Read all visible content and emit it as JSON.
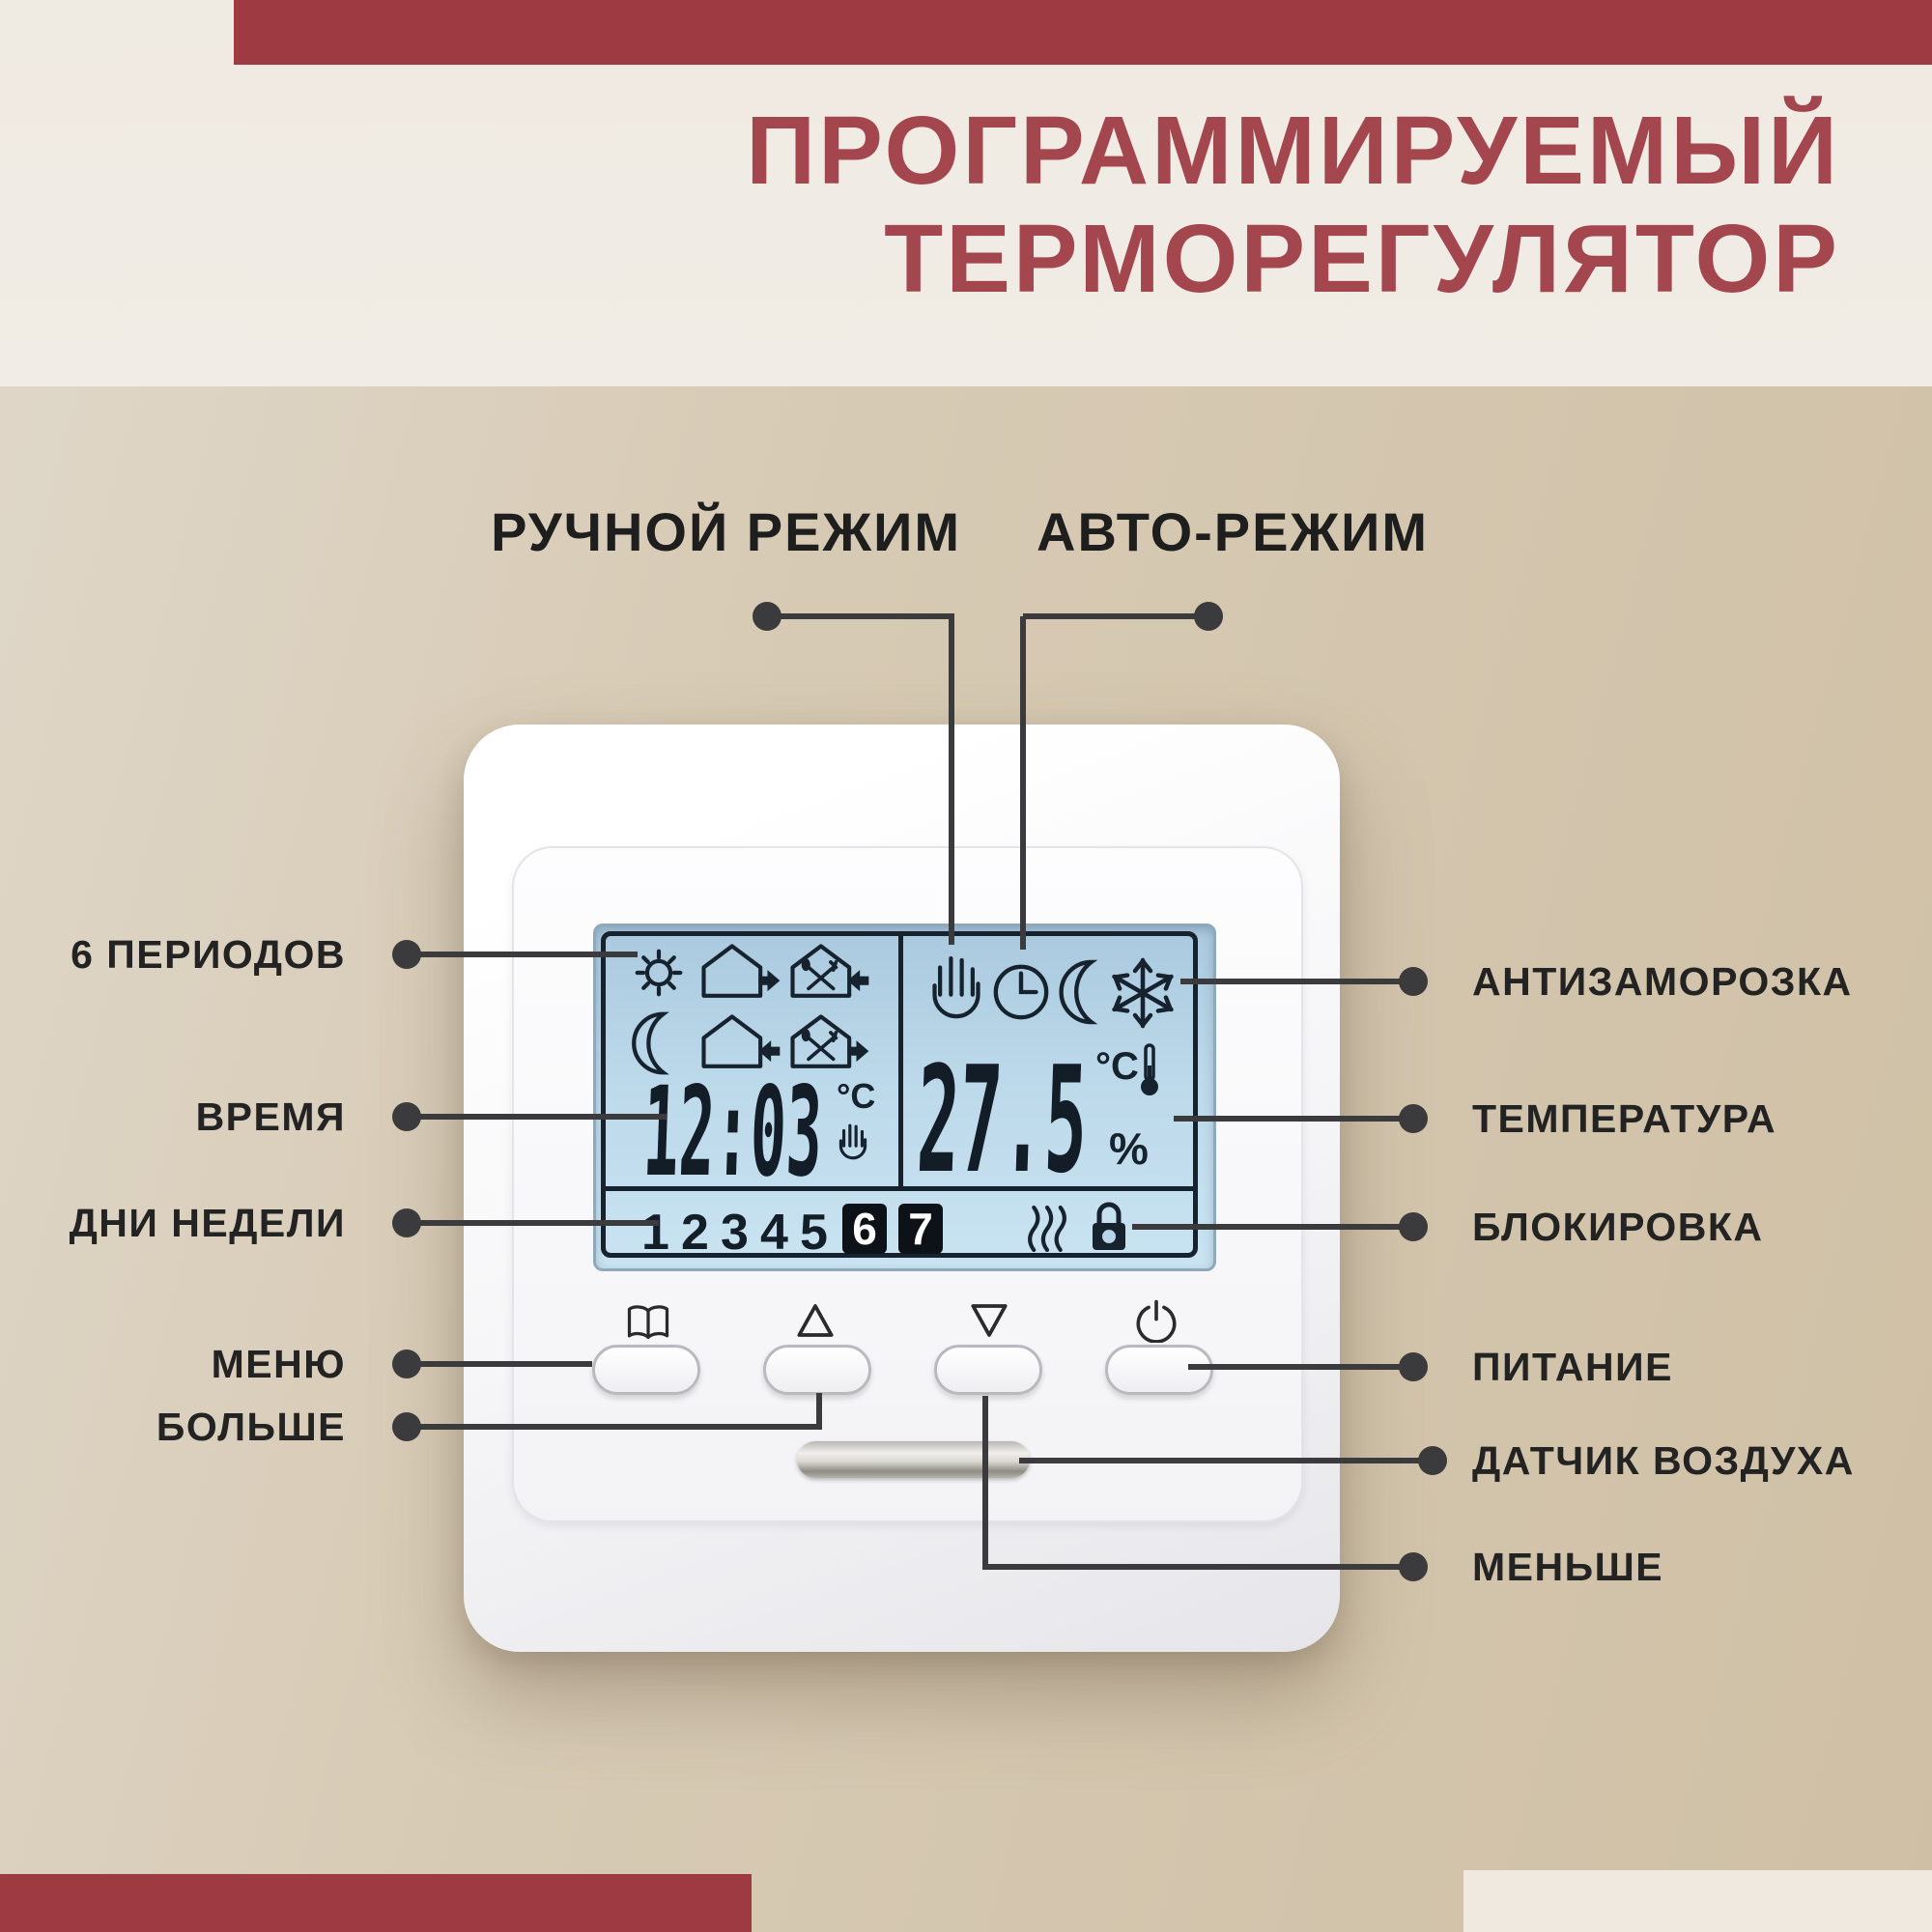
{
  "header": {
    "title_line1": "ПРОГРАММИРУЕМЫЙ",
    "title_line2": "ТЕРМОРЕГУЛЯТОР"
  },
  "modes": {
    "manual_label": "РУЧНОЙ РЕЖИМ",
    "auto_label": "АВТО-РЕЖИМ"
  },
  "callouts": {
    "left": [
      {
        "label": "6 ПЕРИОДОВ"
      },
      {
        "label": "ВРЕМЯ"
      },
      {
        "label": "ДНИ НЕДЕЛИ"
      },
      {
        "label": "МЕНЮ"
      },
      {
        "label": "БОЛЬШЕ"
      }
    ],
    "right": [
      {
        "label": "АНТИЗАМОРОЗКА"
      },
      {
        "label": "ТЕМПЕРАТУРА"
      },
      {
        "label": "БЛОКИРОВКА"
      },
      {
        "label": "ПИТАНИЕ"
      },
      {
        "label": "ДАТЧИК ВОЗДУХА"
      },
      {
        "label": "МЕНЬШЕ"
      }
    ]
  },
  "device": {
    "display": {
      "time": "12:03",
      "time_unit": "°C",
      "temperature": "27.5",
      "temperature_unit": "°C",
      "humidity_unit": "%",
      "days": [
        "1",
        "2",
        "3",
        "4",
        "5"
      ],
      "active_days": [
        "6",
        "7"
      ],
      "left_icons": [
        "sun",
        "house-arrow-out",
        "house-dining-arrow-in",
        "moon",
        "house-arrow-in",
        "house-dining-arrow-out"
      ],
      "right_icons": [
        "hand",
        "clock",
        "moon",
        "snowflake"
      ],
      "status_icons": [
        "heating-waves",
        "lock"
      ],
      "time_mode_icon": "hand"
    },
    "buttons": [
      {
        "icon": "menu-book"
      },
      {
        "icon": "arrow-up"
      },
      {
        "icon": "arrow-down"
      },
      {
        "icon": "power"
      }
    ],
    "sensor_icon": "air-sensor-slot"
  },
  "colors": {
    "accent_red": "#9e3a42",
    "title_red": "#a4464e",
    "background_tan": "#d5c6af",
    "background_cream": "#f0ebe3",
    "line_dark": "#3b3b3d",
    "lcd_blue": "#b7d6e9",
    "lcd_ink": "#16222e"
  }
}
